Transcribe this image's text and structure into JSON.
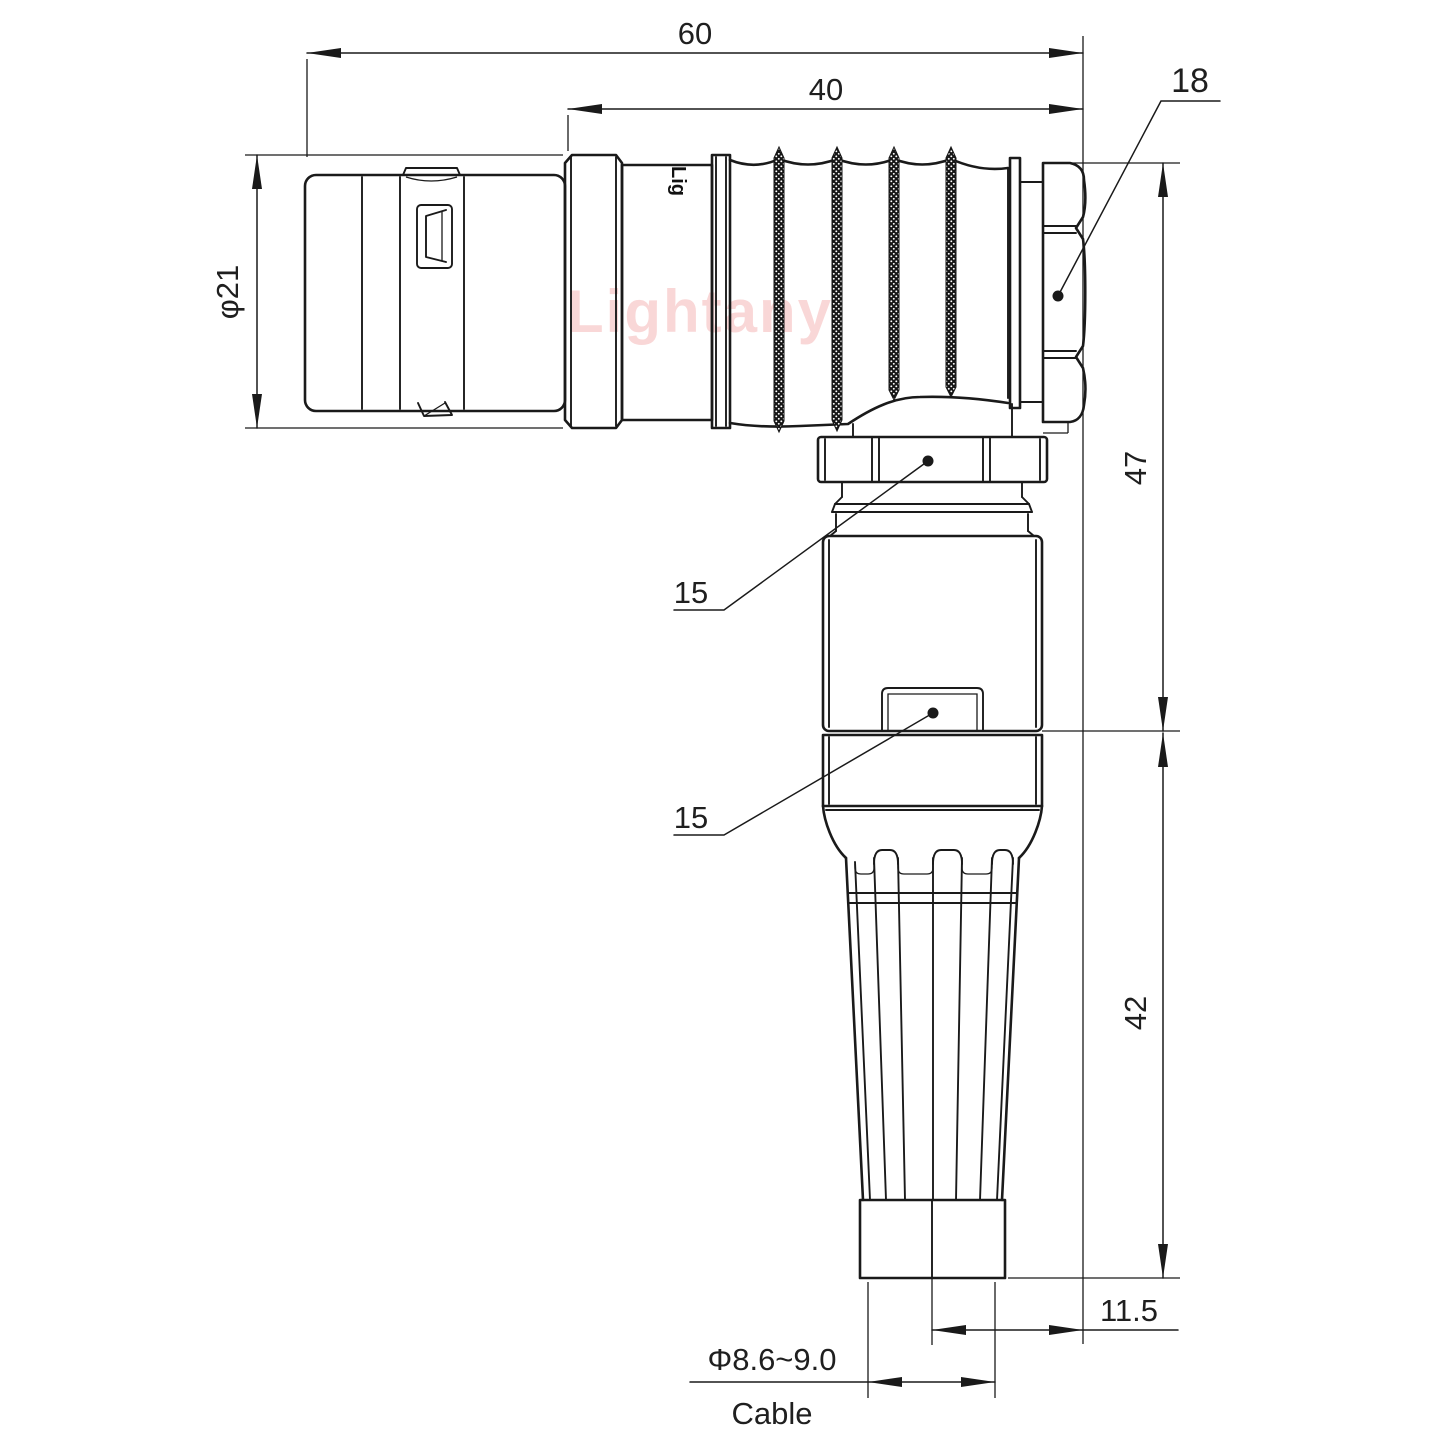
{
  "watermark": {
    "text": "Lightany",
    "color": "#f5b8b8"
  },
  "connector": {
    "brand_text": "Lig"
  },
  "dimensions": {
    "total_length": "60",
    "rear_length": "40",
    "nut": "18",
    "front_diameter": "φ21",
    "upper_height": "47",
    "lower_height": "42",
    "gland_hex": "15",
    "backshell_hex": "15",
    "cable_offset": "11.5",
    "cable_diameter": "Φ8.6~9.0",
    "cable_label": "Cable"
  },
  "colors": {
    "line": "#1a1a1a",
    "background": "#ffffff"
  }
}
